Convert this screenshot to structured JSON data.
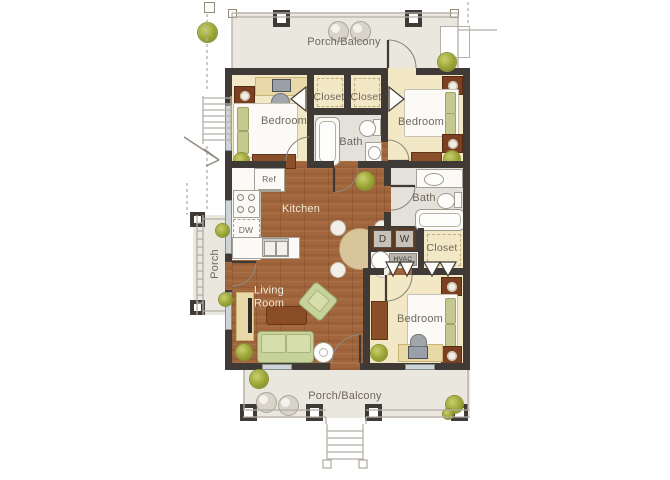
{
  "floorplan": {
    "rooms": {
      "porch_top": "Porch/Balcony",
      "porch_bottom": "Porch/Balcony",
      "porch_side": "Porch",
      "bedroom_top_left": "Bedroom",
      "bedroom_top_right": "Bedroom",
      "bedroom_bottom": "Bedroom",
      "closet_top_left": "Closet",
      "closet_top_right": "Closet",
      "closet_bottom": "Closet",
      "bath_center": "Bath",
      "bath_right": "Bath",
      "kitchen": "Kitchen",
      "living_room": "Living Room"
    },
    "appliances": {
      "refrigerator": "Ref",
      "dishwasher": "DW",
      "dryer": "D",
      "washer": "W",
      "hvac": "HVAC"
    },
    "colors": {
      "wall": "#3f3a35",
      "bedroom_floor": "#f3e8c5",
      "bath_floor": "#e4e1db",
      "wood_floor": "#a2663d",
      "porch_floor": "#eae7df",
      "furniture_green": "#c7d29a",
      "furniture_wood": "#8a5029",
      "plant_green": "#9aa434",
      "label_dark": "#6e685d",
      "label_light": "#f2ead8"
    }
  }
}
